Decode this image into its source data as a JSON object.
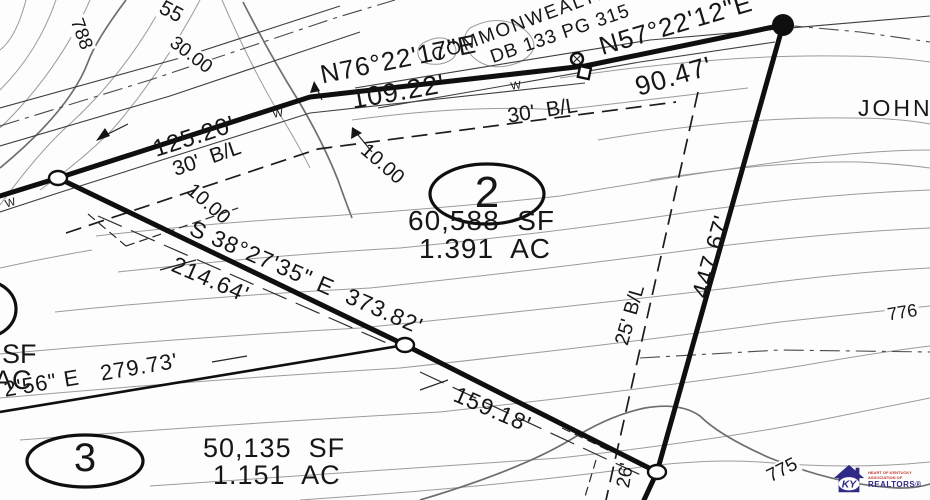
{
  "map": {
    "adjoiners": {
      "commonwealth": "COMMONWEALTH OF",
      "deed": "DB 133 PG 315",
      "john": "JOHN"
    },
    "bearings": {
      "n76": "N76°22'17\"E",
      "n57": "N57°22'12\"E",
      "s38": "S 38°27'35\" E  373.82'",
      "sw_partial": "2'56\" E   279.73'"
    },
    "distances": {
      "d109": "109.22'",
      "d90": "90.47'",
      "d125": "125.20'",
      "d214": "214.64'",
      "d159": "159.18'",
      "d447": "447.67'",
      "d26": "26'"
    },
    "setbacks": {
      "b30_left": "30'  B/L",
      "b30_right": "30'  B/L",
      "b25": "25' B/L",
      "off1": "10.00",
      "off2": "10.00"
    },
    "lots": {
      "lot2": {
        "number": "2",
        "sf": "60,588  SF",
        "ac": "1.391  AC"
      },
      "lot3": {
        "number": "3",
        "sf": "50,135  SF",
        "ac": "1.151  AC"
      },
      "lot_left_partial": {
        "sf": "SF",
        "ac": "AC"
      }
    },
    "contour_labels": {
      "c788": "788",
      "c55": "55",
      "c3000": "30.00",
      "c775": "775",
      "c776": "776"
    },
    "water_marks": [
      "W",
      "W",
      "W"
    ]
  },
  "logo": {
    "ky": "KY",
    "assoc_line": "HEART OF KENTUCKY ASSOCIATION OF",
    "realtors": "REALTORS®"
  },
  "colors": {
    "boundary": "#0f0f0f",
    "contour": "#9b9b9b",
    "logo_purple": "#2e2a85",
    "logo_red": "#c0392b"
  }
}
